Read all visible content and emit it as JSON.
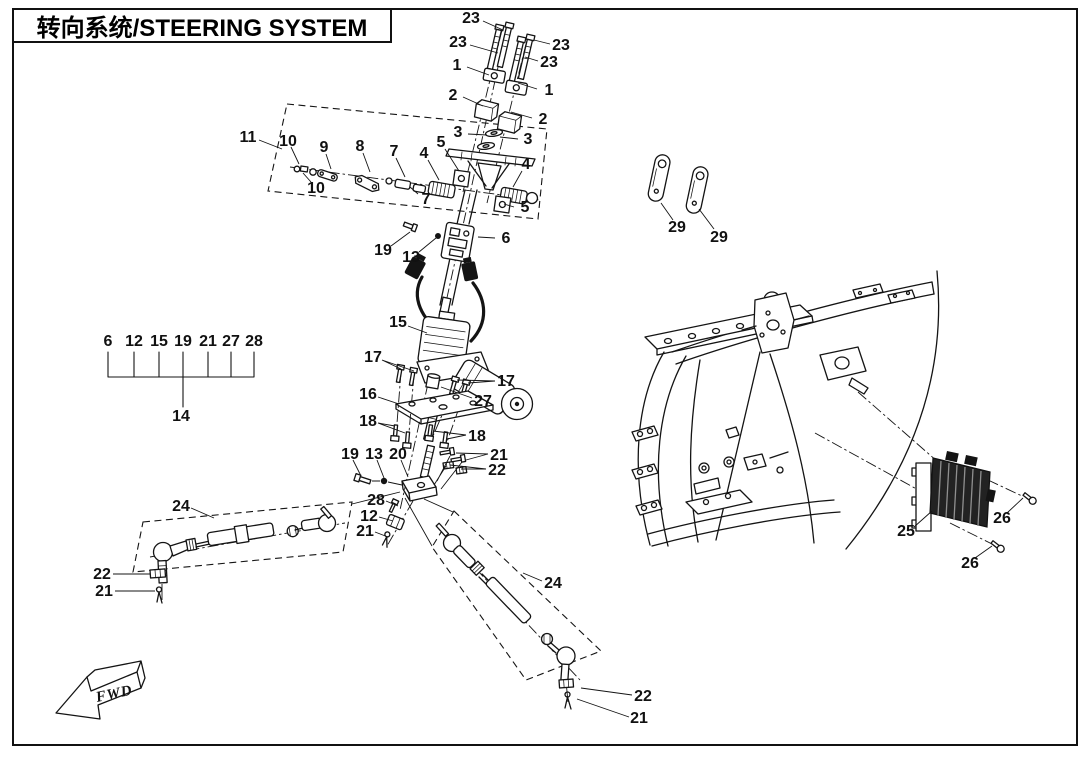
{
  "title": {
    "text": "转向系统/STEERING SYSTEM"
  },
  "fwd": {
    "label": "FWD"
  },
  "legend": {
    "items_y": 346,
    "items": [
      {
        "label": "6",
        "x": 108
      },
      {
        "label": "12",
        "x": 134
      },
      {
        "label": "15",
        "x": 159
      },
      {
        "label": "19",
        "x": 183
      },
      {
        "label": "21",
        "x": 208
      },
      {
        "label": "27",
        "x": 231
      },
      {
        "label": "28",
        "x": 254
      }
    ],
    "group_label": "14"
  },
  "colors": {
    "ink": "#141414",
    "background": "#ffffff"
  },
  "callouts": [
    {
      "part": "23",
      "x": 471,
      "y": 23
    },
    {
      "part": "23",
      "x": 458,
      "y": 47
    },
    {
      "part": "23",
      "x": 561,
      "y": 50
    },
    {
      "part": "23",
      "x": 549,
      "y": 67
    },
    {
      "part": "1",
      "x": 457,
      "y": 70
    },
    {
      "part": "1",
      "x": 549,
      "y": 95
    },
    {
      "part": "2",
      "x": 453,
      "y": 100
    },
    {
      "part": "2",
      "x": 543,
      "y": 124
    },
    {
      "part": "3",
      "x": 458,
      "y": 137
    },
    {
      "part": "3",
      "x": 528,
      "y": 144
    },
    {
      "part": "5",
      "x": 441,
      "y": 147
    },
    {
      "part": "4",
      "x": 424,
      "y": 158
    },
    {
      "part": "4",
      "x": 526,
      "y": 169
    },
    {
      "part": "5",
      "x": 525,
      "y": 212
    },
    {
      "part": "11",
      "x": 248,
      "y": 142
    },
    {
      "part": "10",
      "x": 288,
      "y": 146
    },
    {
      "part": "9",
      "x": 324,
      "y": 152
    },
    {
      "part": "8",
      "x": 360,
      "y": 151
    },
    {
      "part": "7",
      "x": 394,
      "y": 156
    },
    {
      "part": "10",
      "x": 316,
      "y": 193
    },
    {
      "part": "7",
      "x": 426,
      "y": 204
    },
    {
      "part": "19",
      "x": 383,
      "y": 255
    },
    {
      "part": "13",
      "x": 411,
      "y": 262
    },
    {
      "part": "6",
      "x": 506,
      "y": 243
    },
    {
      "part": "15",
      "x": 398,
      "y": 327
    },
    {
      "part": "17",
      "x": 373,
      "y": 362
    },
    {
      "part": "17",
      "x": 506,
      "y": 386
    },
    {
      "part": "16",
      "x": 368,
      "y": 399
    },
    {
      "part": "27",
      "x": 483,
      "y": 406
    },
    {
      "part": "18",
      "x": 368,
      "y": 426
    },
    {
      "part": "18",
      "x": 477,
      "y": 441
    },
    {
      "part": "19",
      "x": 350,
      "y": 459
    },
    {
      "part": "13",
      "x": 374,
      "y": 459
    },
    {
      "part": "20",
      "x": 398,
      "y": 459
    },
    {
      "part": "21",
      "x": 499,
      "y": 460
    },
    {
      "part": "22",
      "x": 497,
      "y": 475
    },
    {
      "part": "28",
      "x": 376,
      "y": 505
    },
    {
      "part": "12",
      "x": 369,
      "y": 521
    },
    {
      "part": "21",
      "x": 365,
      "y": 536
    },
    {
      "part": "24",
      "x": 181,
      "y": 511
    },
    {
      "part": "22",
      "x": 102,
      "y": 579
    },
    {
      "part": "21",
      "x": 104,
      "y": 596
    },
    {
      "part": "24",
      "x": 553,
      "y": 588
    },
    {
      "part": "22",
      "x": 643,
      "y": 701
    },
    {
      "part": "21",
      "x": 639,
      "y": 723
    },
    {
      "part": "29",
      "x": 677,
      "y": 232
    },
    {
      "part": "29",
      "x": 719,
      "y": 242
    },
    {
      "part": "25",
      "x": 906,
      "y": 536
    },
    {
      "part": "26",
      "x": 1002,
      "y": 523
    },
    {
      "part": "26",
      "x": 970,
      "y": 568
    }
  ]
}
